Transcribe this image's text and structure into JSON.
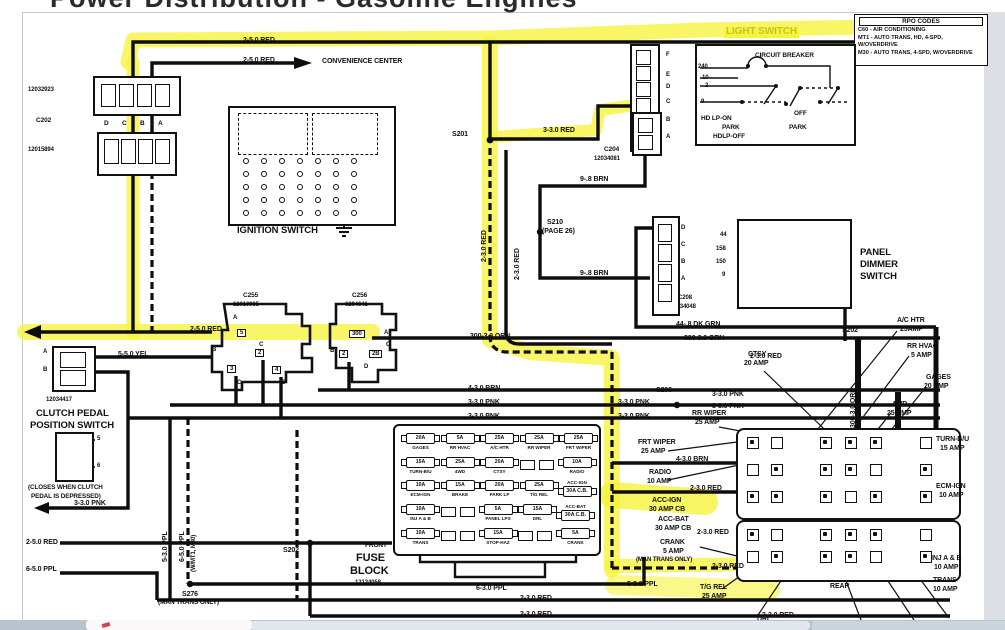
{
  "window": {
    "title": "Power Distribution - Gasoline Engines"
  },
  "colors": {
    "ink": "#111111",
    "highlight": "#f6f33b",
    "paper": "#ffffff"
  },
  "rpo_box": {
    "title": "RPO CODES",
    "lines": [
      "C60 - AIR CONDITIONING",
      "MT1 - AUTO TRANS, HD, 4-SPD, W/OVERDRIVE",
      "M30 - AUTO TRANS, 4-SPD, W/OVERDRIVE"
    ]
  },
  "light_switch": {
    "title": "LIGHT SWITCH",
    "breaker_label": "CIRCUIT BREAKER",
    "contact_labels": [
      "HD LP-ON",
      "PARK",
      "HDLP-OFF",
      "OFF",
      "PARK"
    ],
    "connector_letters": [
      "F",
      "E",
      "D",
      "C",
      "B",
      "A"
    ],
    "circuit_numbers": [
      "240",
      "10",
      "2",
      "9"
    ]
  },
  "ignition_switch": {
    "title": "IGNITION SWITCH",
    "left_connector": "C255",
    "right_connector": "C256",
    "left_pins": [
      "3",
      "2",
      "4",
      "5B"
    ],
    "right_pins": [
      "2",
      "300",
      "2B"
    ],
    "positions": [
      "START",
      "RUN",
      "OFF",
      "LOCK",
      "ACC"
    ]
  },
  "panel_dimmer": {
    "title_lines": [
      "PANEL",
      "DIMMER",
      "SWITCH"
    ],
    "contact_labels": [
      "DIM",
      "BRIGHT",
      "COURTESY",
      "ON"
    ],
    "connector_letters": [
      "D",
      "C",
      "B",
      "A"
    ],
    "circuit_numbers": [
      "44",
      "158",
      "150",
      "9"
    ],
    "connector_name": "C208",
    "connector_part": "12034048"
  },
  "clutch_switch": {
    "title_lines": [
      "CLUTCH PEDAL",
      "POSITION SWITCH"
    ],
    "connector_name": "C203A",
    "connector_part": "12034417",
    "terminal_letters": [
      "A",
      "B"
    ],
    "pin_numbers": [
      "5",
      "6"
    ],
    "note_lines": [
      "(CLOSES WHEN CLUTCH",
      "PEDAL IS DEPRESSED)"
    ]
  },
  "c202": {
    "part_top": "12032923",
    "name": "C202",
    "part_bottom": "12015894",
    "letters": [
      "D",
      "C",
      "B",
      "A"
    ]
  },
  "fuse_block": {
    "caption_lines": [
      "FRONT",
      "FUSE",
      "BLOCK",
      "12124058"
    ],
    "rows": [
      [
        {
          "a": "20A",
          "n": "GAGES"
        },
        {
          "a": "5A",
          "n": "RR HVAC"
        },
        {
          "a": "25A",
          "n": "A/C HTR"
        },
        {
          "a": "25A",
          "n": "RR WIPER"
        },
        {
          "a": "25A",
          "n": "FRT WIPER"
        }
      ],
      [
        {
          "a": "15A",
          "n": "TURN-B/U"
        },
        {
          "a": "25A",
          "n": "4WD"
        },
        {
          "a": "20A",
          "n": "CTSY"
        },
        {
          "e": 1
        },
        {
          "e": 1
        },
        {
          "a": "10A",
          "n": "RADIO"
        }
      ],
      [
        {
          "a": "10A",
          "n": "ECM-IGN"
        },
        {
          "a": "15A",
          "n": "BRAKE"
        },
        {
          "a": "20A",
          "n": "PARK LP"
        },
        {
          "a": "25A",
          "n": "T/G REL"
        },
        {
          "a": "30A C.B.",
          "n": "ACC-IGN",
          "cb": 1
        }
      ],
      [
        {
          "a": "10A",
          "n": "INJ A & B"
        },
        {
          "e": 1
        },
        {
          "e": 1
        },
        {
          "a": "5A",
          "n": "PANEL LPS"
        },
        {
          "a": "15A",
          "n": "DRL"
        },
        {
          "a": "30A C.B.",
          "n": "ACC-BAT",
          "cb": 1
        }
      ],
      [
        {
          "a": "10A",
          "n": "TRANS"
        },
        {
          "e": 1
        },
        {
          "e": 1
        },
        {
          "a": "15A",
          "n": "STOP-HAZ"
        },
        {
          "e": 1
        },
        {
          "e": 1
        },
        {
          "a": "5A",
          "n": "CRANK"
        }
      ]
    ]
  },
  "labels": [
    {
      "t": "2-5.0 RED",
      "x": 243,
      "y": 37
    },
    {
      "t": "2-5.0 RED",
      "x": 243,
      "y": 57
    },
    {
      "t": "CONVENIENCE CENTER",
      "x": 322,
      "y": 58
    },
    {
      "t": "S201",
      "x": 452,
      "y": 131
    },
    {
      "t": "3-3.0 RED",
      "x": 543,
      "y": 127
    },
    {
      "t": "C204",
      "x": 604,
      "y": 147,
      "fs": 6.5
    },
    {
      "t": "12034081",
      "x": 594,
      "y": 156,
      "fs": 6
    },
    {
      "t": "9-.8 BRN",
      "x": 580,
      "y": 176
    },
    {
      "t": "S210",
      "x": 547,
      "y": 219
    },
    {
      "t": "(PAGE 26)",
      "x": 542,
      "y": 228
    },
    {
      "t": "9-.8 BRN",
      "x": 580,
      "y": 270
    },
    {
      "t": "2-3.0 RED",
      "x": 481,
      "y": 262,
      "r": 1
    },
    {
      "t": "2-3.0 RED",
      "x": 514,
      "y": 280,
      "r": 1
    },
    {
      "t": "C255",
      "x": 243,
      "y": 293,
      "fs": 6.5
    },
    {
      "t": "12010985",
      "x": 233,
      "y": 302,
      "fs": 6
    },
    {
      "t": "C256",
      "x": 352,
      "y": 293,
      "fs": 6.5
    },
    {
      "t": "6294641",
      "x": 345,
      "y": 302,
      "fs": 6
    },
    {
      "t": "2-5.0 RED",
      "x": 190,
      "y": 326
    },
    {
      "t": "5-5.0 YEL",
      "x": 118,
      "y": 351
    },
    {
      "t": "3-3.0 PNK",
      "x": 74,
      "y": 500
    },
    {
      "t": "5-3.0 PPL",
      "x": 162,
      "y": 562,
      "r": 1
    },
    {
      "t": "6-5.0 PPL",
      "x": 179,
      "y": 562,
      "r": 1
    },
    {
      "t": "(W/MT1, M30)",
      "x": 191,
      "y": 572,
      "r": 1,
      "fs": 6
    },
    {
      "t": "2-5.0 RED",
      "x": 26,
      "y": 539
    },
    {
      "t": "6-5.0 PPL",
      "x": 26,
      "y": 566
    },
    {
      "t": "S276",
      "x": 182,
      "y": 591
    },
    {
      "t": "(MAN TRANS ONLY)",
      "x": 158,
      "y": 600,
      "fs": 6.5
    },
    {
      "t": "S202",
      "x": 283,
      "y": 547
    },
    {
      "t": "S202",
      "x": 842,
      "y": 327
    },
    {
      "t": "44-.8 DK GRN",
      "x": 676,
      "y": 321
    },
    {
      "t": "300-3.0 ORN",
      "x": 470,
      "y": 333
    },
    {
      "t": "300-3.0 ORN",
      "x": 684,
      "y": 335
    },
    {
      "t": "2-3.0 RED",
      "x": 750,
      "y": 353
    },
    {
      "t": "4-3.0 BRN",
      "x": 468,
      "y": 385
    },
    {
      "t": "3-3.0 PNK",
      "x": 468,
      "y": 399
    },
    {
      "t": "3-3.0 PNK",
      "x": 468,
      "y": 413
    },
    {
      "t": "3-3.0 PNK",
      "x": 618,
      "y": 399
    },
    {
      "t": "3-3.0 PNK",
      "x": 618,
      "y": 413
    },
    {
      "t": "S206",
      "x": 656,
      "y": 387
    },
    {
      "t": "3-3.0 PNK",
      "x": 712,
      "y": 391
    },
    {
      "t": "3-3.0 PNK",
      "x": 712,
      "y": 403
    },
    {
      "t": "300-3.0 ORN",
      "x": 850,
      "y": 428,
      "r": 1
    },
    {
      "t": "CTSY",
      "x": 748,
      "y": 351
    },
    {
      "t": "20 AMP",
      "x": 744,
      "y": 360
    },
    {
      "t": "RR WIPER",
      "x": 692,
      "y": 410
    },
    {
      "t": "25 AMP",
      "x": 695,
      "y": 419
    },
    {
      "t": "FRT WIPER",
      "x": 638,
      "y": 439
    },
    {
      "t": "25 AMP",
      "x": 641,
      "y": 448
    },
    {
      "t": "4-3.0 BRN",
      "x": 676,
      "y": 456
    },
    {
      "t": "RADIO",
      "x": 649,
      "y": 469
    },
    {
      "t": "10 AMP",
      "x": 647,
      "y": 478
    },
    {
      "t": "2-3.0 RED",
      "x": 690,
      "y": 485
    },
    {
      "t": "ACC-IGN",
      "x": 652,
      "y": 497
    },
    {
      "t": "30 AMP CB",
      "x": 649,
      "y": 506
    },
    {
      "t": "ACC-BAT",
      "x": 658,
      "y": 516
    },
    {
      "t": "30 AMP CB",
      "x": 655,
      "y": 525
    },
    {
      "t": "2-3.0 RED",
      "x": 697,
      "y": 529
    },
    {
      "t": "CRANK",
      "x": 660,
      "y": 539
    },
    {
      "t": "5 AMP",
      "x": 663,
      "y": 548
    },
    {
      "t": "(MAN TRANS ONLY)",
      "x": 636,
      "y": 557,
      "fs": 6
    },
    {
      "t": "2-3.0 RED",
      "x": 712,
      "y": 563
    },
    {
      "t": "5-3.0 PPL",
      "x": 627,
      "y": 581
    },
    {
      "t": "T/G REL",
      "x": 700,
      "y": 584
    },
    {
      "t": "25 AMP",
      "x": 702,
      "y": 593
    },
    {
      "t": "6-3.0 PPL",
      "x": 476,
      "y": 585
    },
    {
      "t": "2-3.0 RED",
      "x": 520,
      "y": 595
    },
    {
      "t": "2-3.0 RED",
      "x": 520,
      "y": 611
    },
    {
      "t": "2-3.0 RED",
      "x": 762,
      "y": 612
    },
    {
      "t": "DRL",
      "x": 757,
      "y": 616
    },
    {
      "t": "REAR",
      "x": 830,
      "y": 583
    },
    {
      "t": "A/C HTR",
      "x": 897,
      "y": 317
    },
    {
      "t": "25AMP",
      "x": 900,
      "y": 326
    },
    {
      "t": "RR HVAC",
      "x": 907,
      "y": 343
    },
    {
      "t": "5 AMP",
      "x": 911,
      "y": 352
    },
    {
      "t": "GAGES",
      "x": 926,
      "y": 374
    },
    {
      "t": "20 AMP",
      "x": 924,
      "y": 383
    },
    {
      "t": "4WD",
      "x": 892,
      "y": 401
    },
    {
      "t": "25 AMP",
      "x": 887,
      "y": 410
    },
    {
      "t": "TURN-B/U",
      "x": 936,
      "y": 436
    },
    {
      "t": "15 AMP",
      "x": 940,
      "y": 445
    },
    {
      "t": "ECM-IGN",
      "x": 936,
      "y": 483
    },
    {
      "t": "10 AMP",
      "x": 939,
      "y": 492
    },
    {
      "t": "INJ A & B",
      "x": 931,
      "y": 555
    },
    {
      "t": "10 AMP",
      "x": 934,
      "y": 564
    },
    {
      "t": "TRANS",
      "x": 933,
      "y": 577
    },
    {
      "t": "10 AMP",
      "x": 933,
      "y": 586
    },
    {
      "t": "A",
      "x": 233,
      "y": 315,
      "fs": 6
    },
    {
      "t": "B",
      "x": 212,
      "y": 347,
      "fs": 6
    },
    {
      "t": "C",
      "x": 259,
      "y": 342,
      "fs": 6
    },
    {
      "t": "C",
      "x": 237,
      "y": 380,
      "fs": 6
    },
    {
      "t": "E",
      "x": 281,
      "y": 380,
      "fs": 6
    },
    {
      "t": "5",
      "x": 237,
      "y": 329,
      "box": 1
    },
    {
      "t": "2",
      "x": 255,
      "y": 349,
      "box": 1
    },
    {
      "t": "3",
      "x": 227,
      "y": 365,
      "box": 1
    },
    {
      "t": "4",
      "x": 272,
      "y": 366,
      "box": 1
    },
    {
      "t": "B",
      "x": 330,
      "y": 348,
      "fs": 6
    },
    {
      "t": "A",
      "x": 384,
      "y": 330,
      "fs": 6
    },
    {
      "t": "C",
      "x": 386,
      "y": 342,
      "fs": 6
    },
    {
      "t": "D",
      "x": 364,
      "y": 364,
      "fs": 6
    },
    {
      "t": "300",
      "x": 349,
      "y": 330,
      "box": 1
    },
    {
      "t": "2",
      "x": 339,
      "y": 350,
      "box": 1
    },
    {
      "t": "2B",
      "x": 369,
      "y": 350,
      "box": 1
    }
  ]
}
